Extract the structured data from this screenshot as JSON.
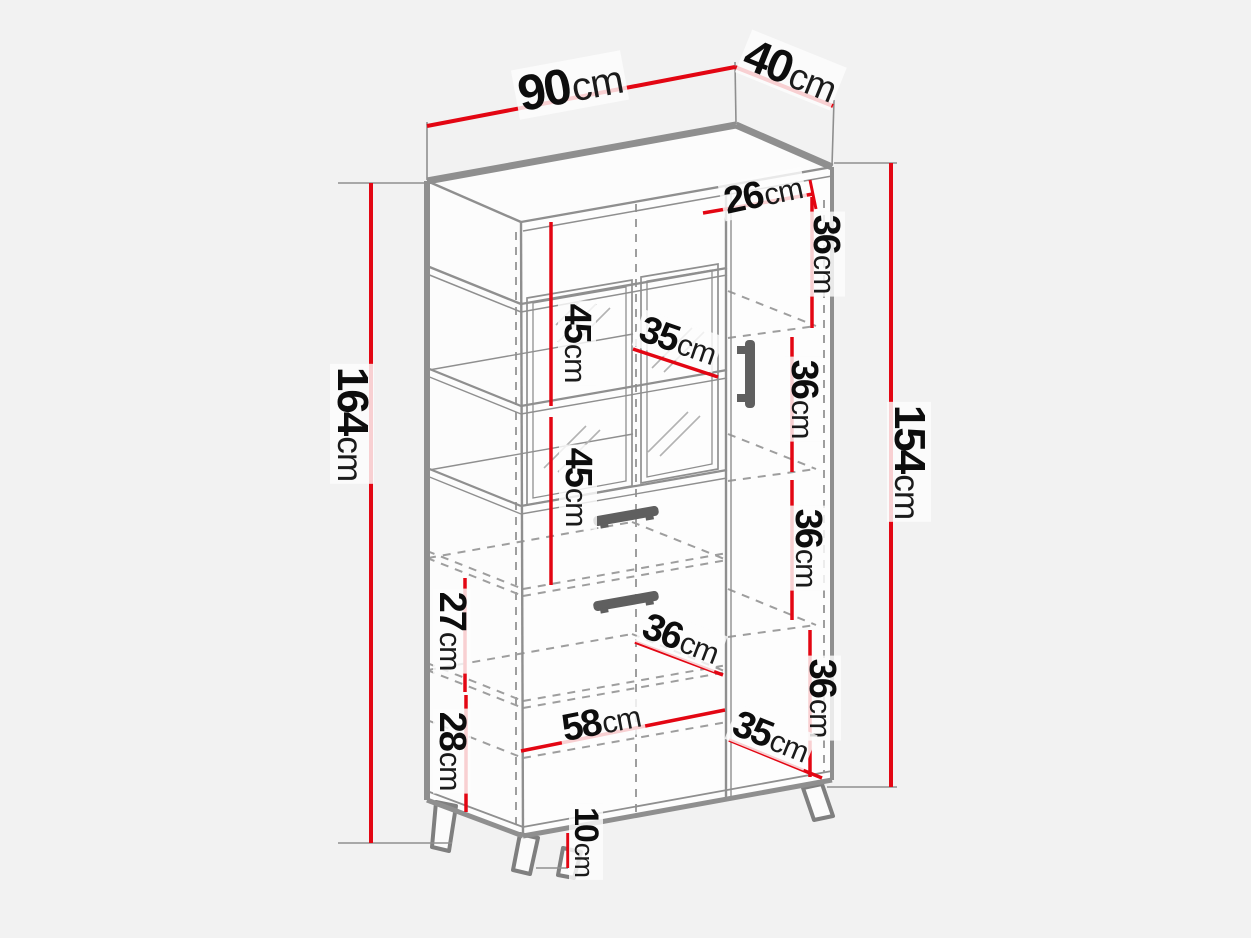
{
  "diagram": {
    "type": "furniture-dimension-drawing",
    "subject": "tall display cabinet with glass doors, drawers, side shelf column and angled legs",
    "unit": "cm"
  },
  "colors": {
    "dimension_line": "#e30613",
    "outline_gray": "#8f8f8f",
    "dashed_gray": "#9e9e9e",
    "handle_gray": "#5f5f5f",
    "background": "#f2f2f2",
    "label_text": "#0d0d0d"
  },
  "dimensions": {
    "top_width": {
      "num": "90",
      "unit": "cm"
    },
    "top_depth": {
      "num": "40",
      "unit": "cm"
    },
    "total_height": {
      "num": "164",
      "unit": "cm"
    },
    "carcass_height": {
      "num": "154",
      "unit": "cm"
    },
    "right_top_width": {
      "num": "26",
      "unit": "cm"
    },
    "right_comp_1": {
      "num": "36",
      "unit": "cm"
    },
    "right_comp_2": {
      "num": "36",
      "unit": "cm"
    },
    "right_comp_3": {
      "num": "36",
      "unit": "cm"
    },
    "right_comp_4": {
      "num": "36",
      "unit": "cm"
    },
    "glass_upper": {
      "num": "45",
      "unit": "cm"
    },
    "glass_lower": {
      "num": "45",
      "unit": "cm"
    },
    "shelf_depth_35": {
      "num": "35",
      "unit": "cm"
    },
    "interior_depth_36": {
      "num": "36",
      "unit": "cm"
    },
    "interior_width_58": {
      "num": "58",
      "unit": "cm"
    },
    "bottom_right_depth_35": {
      "num": "35",
      "unit": "cm"
    },
    "shelf_gap_27": {
      "num": "27",
      "unit": "cm"
    },
    "shelf_gap_28": {
      "num": "28",
      "unit": "cm"
    },
    "leg_height": {
      "num": "10",
      "unit": "cm"
    }
  }
}
